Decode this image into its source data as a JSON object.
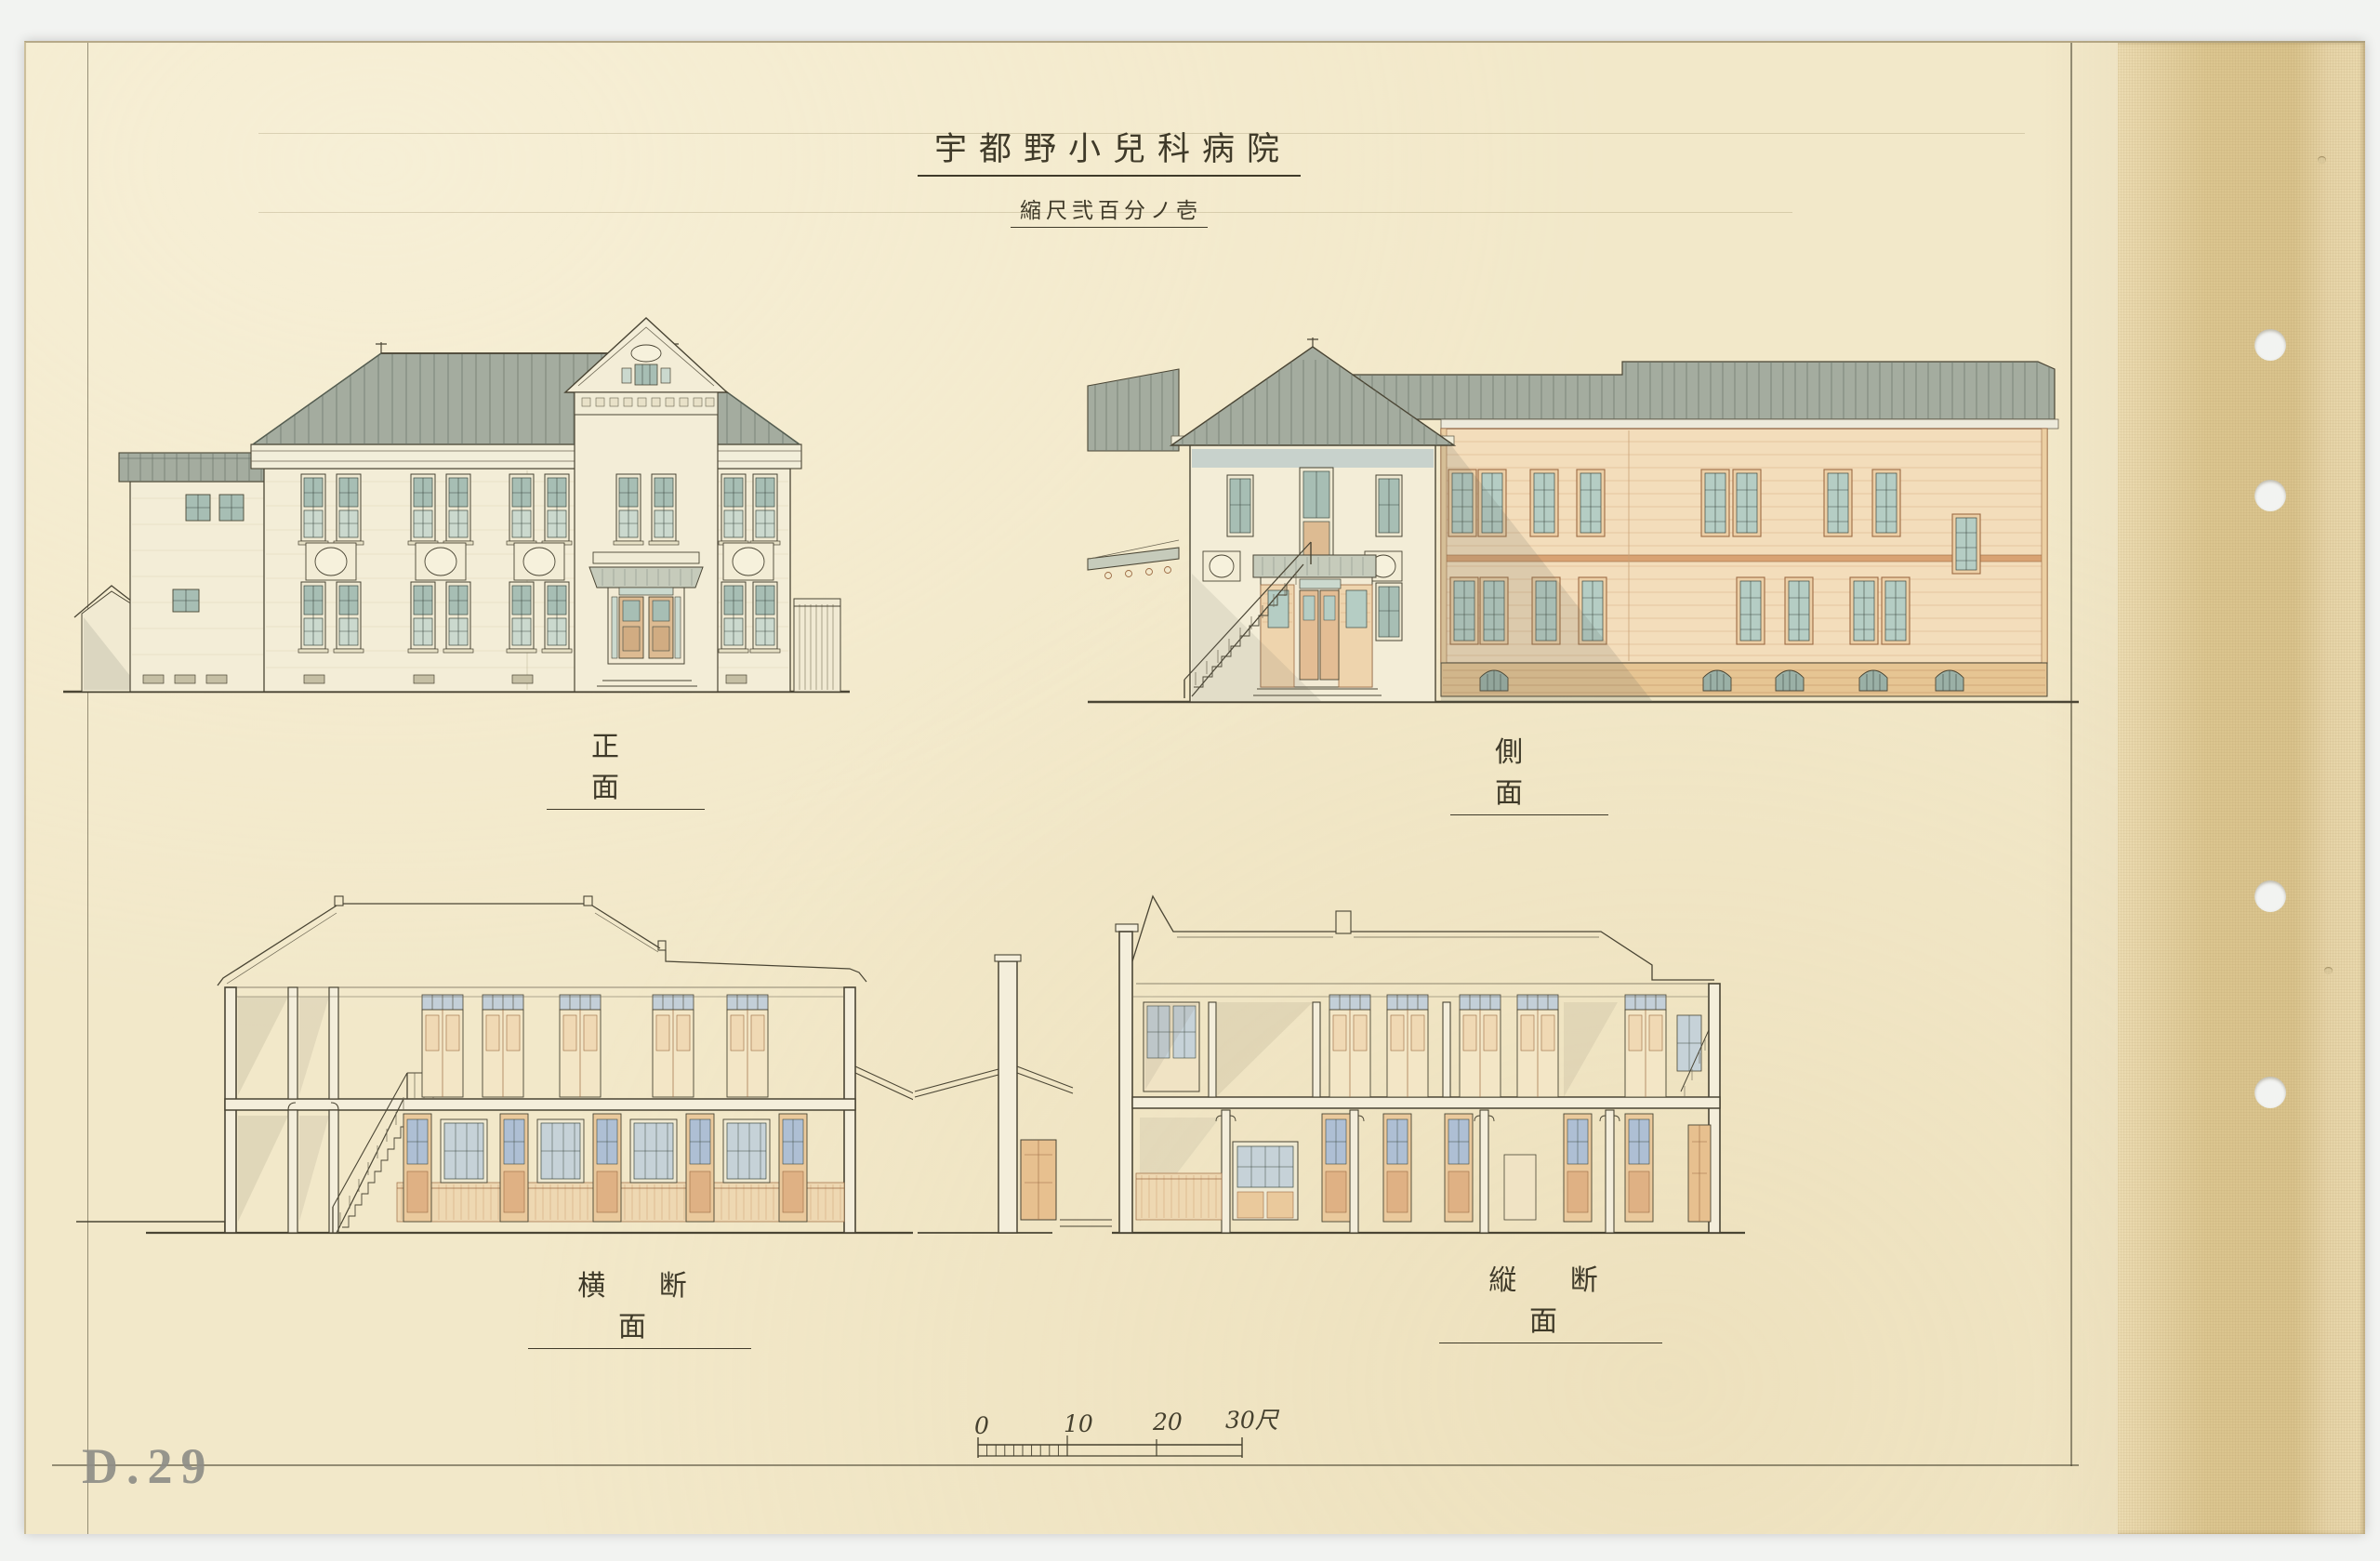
{
  "document": {
    "title": "宇都野小兒科病院",
    "scale_note": "縮尺弐百分ノ壱",
    "archive_stamp": "D.29"
  },
  "drawings": {
    "front_elevation": {
      "label": "正 面"
    },
    "side_elevation": {
      "label": "側 面"
    },
    "cross_section": {
      "label": "横 断 面"
    },
    "longitudinal_section": {
      "label": "縦 断 面"
    }
  },
  "scale_bar": {
    "ticks": [
      "0",
      "10",
      "20",
      "30尺"
    ]
  },
  "colors": {
    "paper": "#f2e8c9",
    "binding_tape": "#e7d6aa",
    "ink": "#4a4534",
    "roof_metal": "#a4ac9f",
    "wall_plaster": "#f3edd7",
    "window_glass": "#aec3b9",
    "wing_siding": "#f3ddbb",
    "wing_trim": "#c98a5e",
    "brick_base": "#e6c593",
    "stamp_gray": "#8f8e87"
  }
}
